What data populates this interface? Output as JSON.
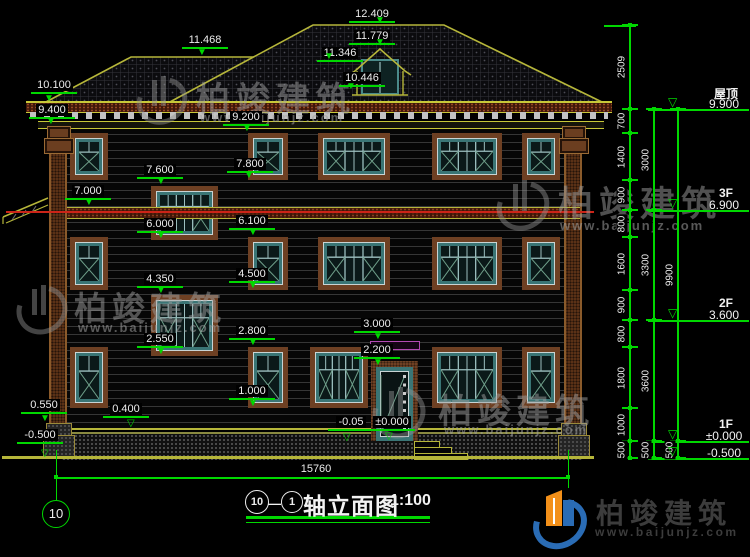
{
  "watermark": {
    "brand": "柏竣建筑",
    "url": "www.baijunjz.com"
  },
  "logo": {
    "brand": "柏竣建筑",
    "url": "www.baijunjz.com"
  },
  "title_bar": {
    "axis_from": "10",
    "axis_sep": "—",
    "axis_to": "1",
    "name": "轴立面图",
    "scale": "1:100"
  },
  "axis_bubble": {
    "label": "10"
  },
  "overall_dim": {
    "value": "15760"
  },
  "icons": {
    "arrow_filled": "▼",
    "arrow_open": "▽"
  },
  "facade_dims": [
    {
      "id": "d12409",
      "value": "12.409"
    },
    {
      "id": "d11779",
      "value": "11.779"
    },
    {
      "id": "d11346",
      "value": "11.346"
    },
    {
      "id": "d10446",
      "value": "10.446"
    },
    {
      "id": "d11468",
      "value": "11.468"
    },
    {
      "id": "d10100",
      "value": "10.100"
    },
    {
      "id": "d9400",
      "value": "9.400"
    },
    {
      "id": "d9200",
      "value": "9.200"
    },
    {
      "id": "d7800",
      "value": "7.800"
    },
    {
      "id": "d7600",
      "value": "7.600"
    },
    {
      "id": "d7000",
      "value": "7.000"
    },
    {
      "id": "d6100",
      "value": "6.100"
    },
    {
      "id": "d6000",
      "value": "6.000"
    },
    {
      "id": "d4500",
      "value": "4.500"
    },
    {
      "id": "d4350",
      "value": "4.350"
    },
    {
      "id": "d3000",
      "value": "3.000"
    },
    {
      "id": "d2800",
      "value": "2.800"
    },
    {
      "id": "d2550",
      "value": "2.550"
    },
    {
      "id": "d2200",
      "value": "2.200"
    },
    {
      "id": "d1000",
      "value": "1.000"
    },
    {
      "id": "d0550",
      "value": "0.550"
    },
    {
      "id": "d0400",
      "value": "0.400"
    },
    {
      "id": "dm0050",
      "value": "-0.05"
    },
    {
      "id": "dpm0",
      "value": "±0.000"
    },
    {
      "id": "dm0500",
      "value": "-0.500"
    }
  ],
  "right_levels": [
    {
      "name": "屋顶",
      "value": "9.900"
    },
    {
      "name": "3F",
      "value": "6.900"
    },
    {
      "name": "2F",
      "value": "3.600"
    },
    {
      "name": "1F",
      "value": "±0.000"
    },
    {
      "name": "",
      "value": "-0.500"
    }
  ],
  "chains": {
    "a": [
      "2509",
      "700",
      "1400",
      "900",
      "800",
      "1600",
      "900",
      "800",
      "1800",
      "1000",
      "500"
    ],
    "b": [
      "3000",
      "3300",
      "3600",
      "500"
    ],
    "c": [
      "9900",
      "500"
    ]
  }
}
